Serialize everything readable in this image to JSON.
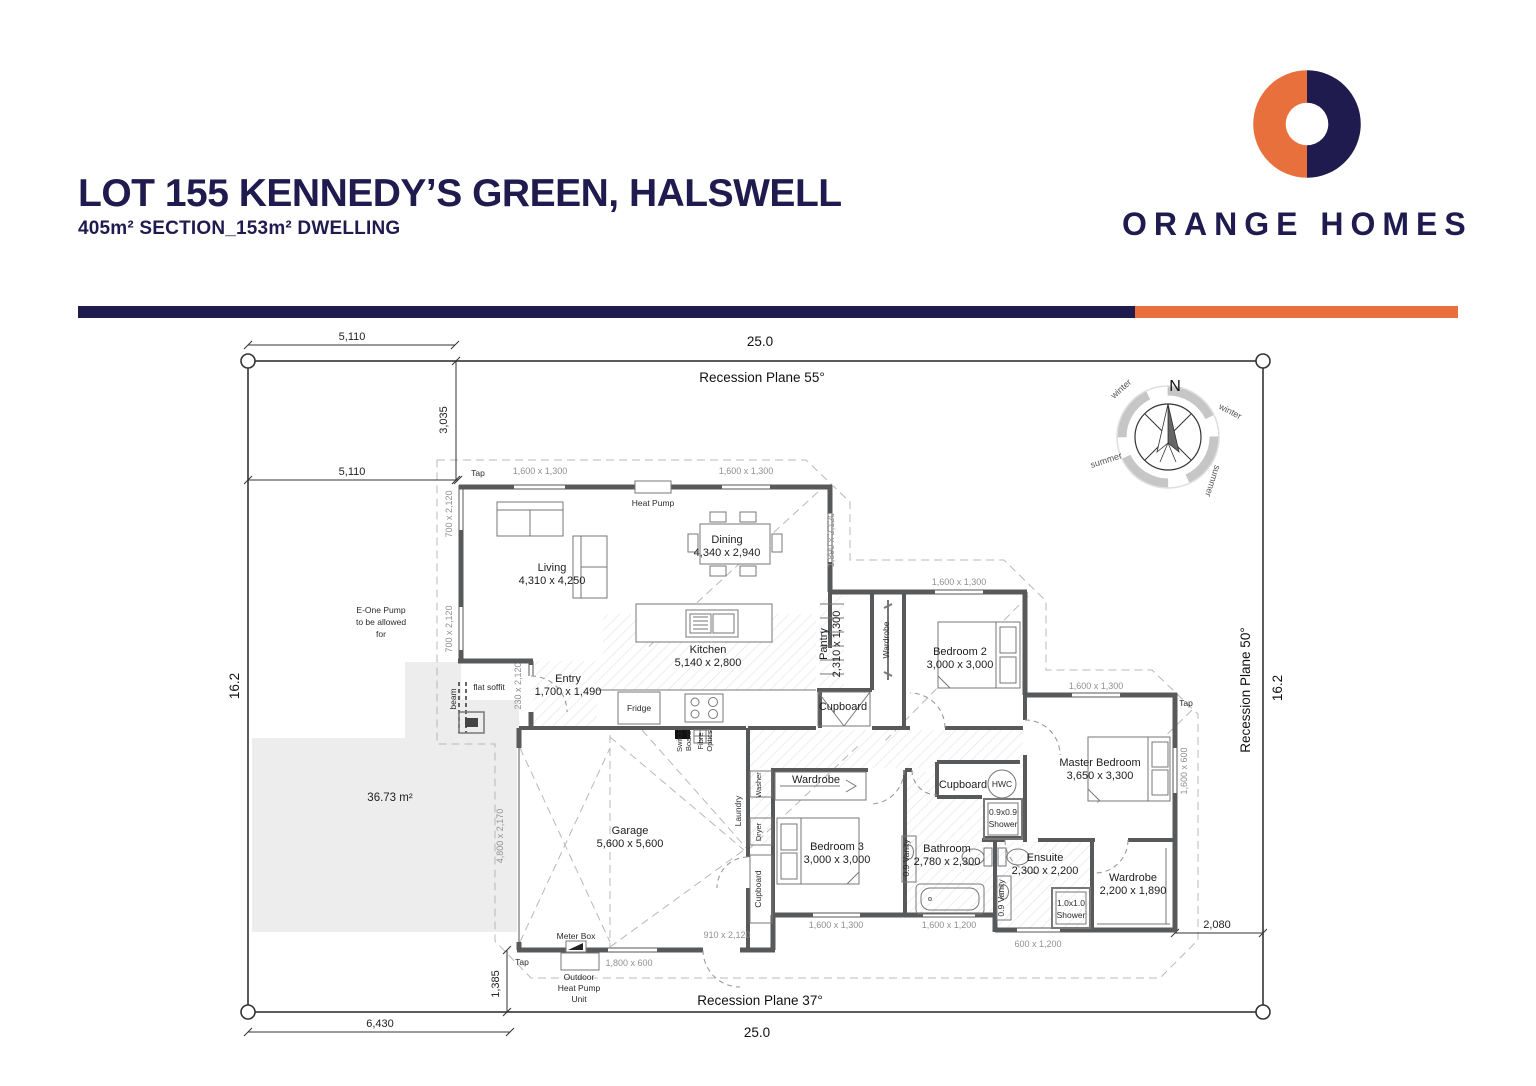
{
  "header": {
    "title": "LOT 155 KENNEDY’S GREEN, HALSWELL",
    "subtitle": "405m² SECTION_153m² DWELLING",
    "brand": "ORANGE HOMES",
    "colors": {
      "navy": "#201b4e",
      "orange": "#e7703c"
    }
  },
  "site": {
    "plane55": "Recession Plane 55°",
    "plane50": "Recession Plane 50°",
    "plane37": "Recession Plane 37°",
    "width_top": "25.0",
    "width_bottom": "25.0",
    "depth_left": "16.2",
    "depth_right": "16.2",
    "driveway_area": "36.73 m²",
    "epump_1": "E-One Pump",
    "epump_2": "to be allowed",
    "epump_3": "for"
  },
  "dims": {
    "d5110": "5,110",
    "d3035": "3,035",
    "d6430": "6,430",
    "d1385": "1,385",
    "d2080": "2,080"
  },
  "rooms": {
    "living": {
      "name": "Living",
      "dims": "4,310 x 4,250"
    },
    "dining": {
      "name": "Dining",
      "dims": "4,340 x 2,940"
    },
    "kitchen": {
      "name": "Kitchen",
      "dims": "5,140 x 2,800"
    },
    "entry": {
      "name": "Entry",
      "dims": "1,700 x 1,490"
    },
    "garage": {
      "name": "Garage",
      "dims": "5,600 x 5,600"
    },
    "bedroom2": {
      "name": "Bedroom 2",
      "dims": "3,000 x 3,000"
    },
    "bedroom3": {
      "name": "Bedroom 3",
      "dims": "3,000 x 3,000"
    },
    "master": {
      "name": "Master Bedroom",
      "dims": "3,650 x 3,300"
    },
    "bathroom": {
      "name": "Bathroom",
      "dims": "2,780 x 2,300"
    },
    "ensuite": {
      "name": "Ensuite",
      "dims": "2,300 x 2,200"
    },
    "robe_master": {
      "name": "Wardrobe",
      "dims": "2,200 x 1,890"
    },
    "pantry": {
      "name": "Pantry",
      "dims": "2,310 x 1,300"
    }
  },
  "fixtures": {
    "heat_pump": "Heat Pump",
    "fridge": "Fridge",
    "hwc": "HWC",
    "cupboard": "Cupboard",
    "wardrobe": "Wardrobe",
    "laundry": "Laundry",
    "washer": "Washer",
    "dryer": "Dryer",
    "meter_box": "Meter Box",
    "switch_1": "Switch",
    "switch_2": "Board",
    "fibre_1": "Fibre",
    "fibre_2": "Optics",
    "shower09_1": "0.9x0.9",
    "shower09_2": "Shower",
    "shower10_1": "1.0x1.0",
    "shower10_2": "Shower",
    "vanity": "0.9 Vanity",
    "tap": "Tap",
    "beam": "beam",
    "flat_soffit": "flat soffit",
    "ohp_1": "Outdoor",
    "ohp_2": "Heat Pump",
    "ohp_3": "Unit"
  },
  "windows": {
    "w1600x1300": "1,600 x 1,300",
    "w1600x1200": "1,600 x 1,200",
    "w1600x600": "1,600 x 600",
    "w700x2120": "700 x 2,120",
    "w230x2120": "230 x 2,120",
    "w1890x2120": "1,890 x 2,120",
    "w1800x600": "1,800 x 600",
    "w910x2120": "910 x 2,120",
    "w600x1200": "600 x 1,200",
    "w4800x2170": "4,800 x 2,170"
  },
  "compass": {
    "n": "N",
    "winter": "winter",
    "summer": "summer"
  }
}
